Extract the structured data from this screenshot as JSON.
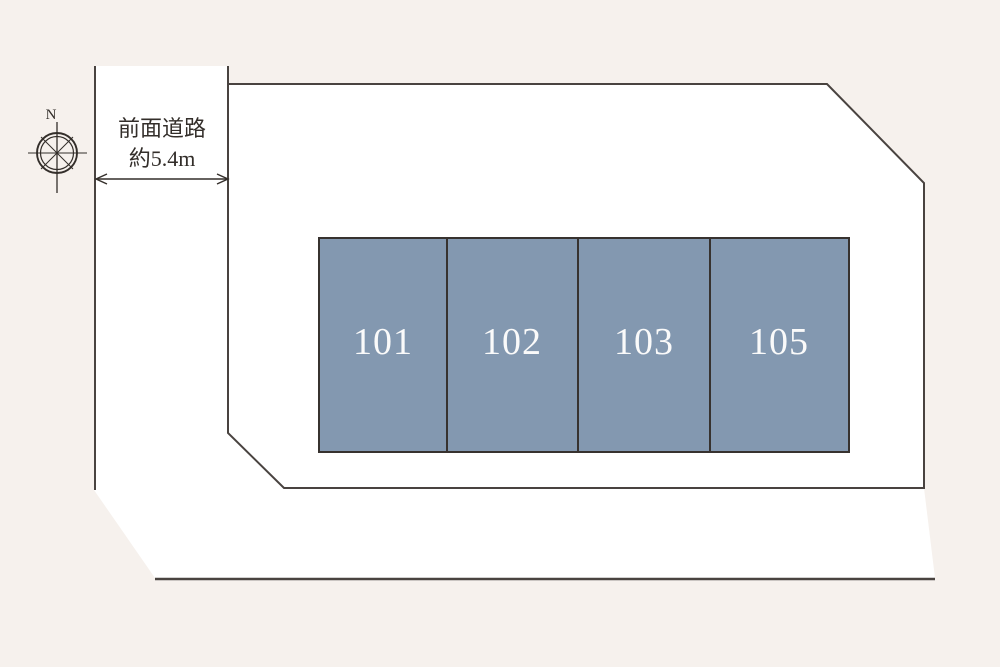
{
  "colors": {
    "background": "#f6f1ed",
    "site_white": "#ffffff",
    "outline": "#494340",
    "unit_fill": "#8398b0",
    "unit_border": "#37322f",
    "unit_text": "#fafafa",
    "annotation": "#332e2a"
  },
  "compass": {
    "north_label": "N"
  },
  "road": {
    "label_line1": "前面道路",
    "label_line2": "約5.4m"
  },
  "units": [
    {
      "label": "101"
    },
    {
      "label": "102"
    },
    {
      "label": "103"
    },
    {
      "label": "105"
    }
  ]
}
